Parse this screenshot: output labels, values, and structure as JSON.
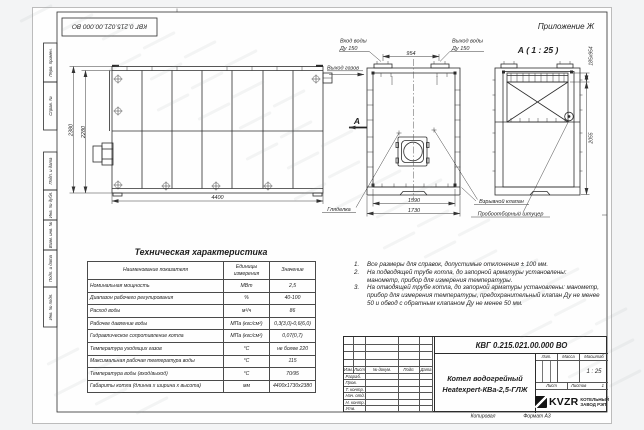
{
  "frame": {
    "stamp_top": "КВГ 0.215.021.00.000 ВО",
    "appendix": "Приложение Ж",
    "copied": "Копировал",
    "format": "Формат А3",
    "side_labels": [
      "Перв. примен.",
      "Справ. №",
      "Подп. и дата",
      "Инв. № дубл.",
      "Взам. инв. №",
      "Подп. и дата",
      "Инв. № подл."
    ]
  },
  "views": {
    "side_view": {
      "dim_height_outer": "2380",
      "dim_height_inner": "2280",
      "dim_length": "4400"
    },
    "front_view": {
      "label_water_in": "Вход воды",
      "label_water_in_dn": "Ду 150",
      "label_water_out": "Выход воды",
      "label_water_out_dn": "Ду 150",
      "label_gas_out": "Выход газов",
      "dim_nozzle_span": "954",
      "dim_width_inner": "1590",
      "dim_width_outer": "1730",
      "section_letter": "А",
      "label_sight_glass": "Гляделка"
    },
    "section_view": {
      "title": "А ( 1 : 25 )",
      "dim_top": "185х954",
      "dim_height": "2055",
      "label_explosion_valve": "Взрывной клапан",
      "label_sampling_fitting": "Пробоотборный штуцер"
    }
  },
  "spec_table": {
    "title": "Техническая характеристика",
    "columns": [
      "Наименование показателя",
      "Единицы измерения",
      "Значение"
    ],
    "rows": [
      {
        "name": "Номинальная мощность",
        "unit": "МВт",
        "value": "2,5"
      },
      {
        "name": "Диапазон рабочего регулирования",
        "unit": "%",
        "value": "40-100"
      },
      {
        "name": "Расход воды",
        "unit": "м³/ч",
        "value": "86"
      },
      {
        "name": "Рабочее давление воды",
        "unit": "МПа (кгс/см²)",
        "value": "0,3(3,0)-0,6(6,0)"
      },
      {
        "name": "Гидравлическое сопротивление котла",
        "unit": "МПа (кгс/см²)",
        "value": "0,07(0,7)"
      },
      {
        "name": "Температура уходящих газов",
        "unit": "°С",
        "value": "не более 220"
      },
      {
        "name": "Максимальная рабочая температура воды",
        "unit": "°С",
        "value": "115"
      },
      {
        "name": "Температура воды (вход/выход)",
        "unit": "°С",
        "value": "70/95"
      },
      {
        "name": "Габариты котла (длинна х ширина х высота)",
        "unit": "мм",
        "value": "4400х1730х2380"
      }
    ]
  },
  "notes": {
    "items": [
      {
        "num": "1.",
        "text": "Все размеры для справок, допустимые отклонения ± 100 мм."
      },
      {
        "num": "2.",
        "text": "На подводящей трубе котла, до запорной арматуры установлены: манометр, прибор для измерения температуры."
      },
      {
        "num": "3.",
        "text": "На отводящей трубе котла, до запорной арматуры установлены: манометр, прибор для измерения температуры, предохранительный клапан Ду не менее 50 и обвод с обратным клапаном Ду не менее 50 мм."
      }
    ]
  },
  "title_block": {
    "doc_number": "КВГ 0.215.021.00.000 ВО",
    "product_line1": "Котел водогрейный",
    "product_line2": "Heatexpert-КВа-2,5-ГЛЖ",
    "change_header": [
      "Изм.",
      "Лист",
      "№ докум.",
      "Подп.",
      "Дата"
    ],
    "sign_rows": [
      "Разраб.",
      "Пров.",
      "Т. контр.",
      "Нач. отд.",
      "Н. контр.",
      "Утв."
    ],
    "lit_label": "Лит.",
    "mass_label": "Масса",
    "scale_label": "Масштаб",
    "scale_value": "1 : 25",
    "sheet_label": "Лист",
    "sheets_label": "Листов",
    "sheets_value": "1",
    "company_abbr": "KVZR",
    "company_line1": "КОТЕЛЬНЫЙ",
    "company_line2": "ЗАВОД РЭП"
  }
}
